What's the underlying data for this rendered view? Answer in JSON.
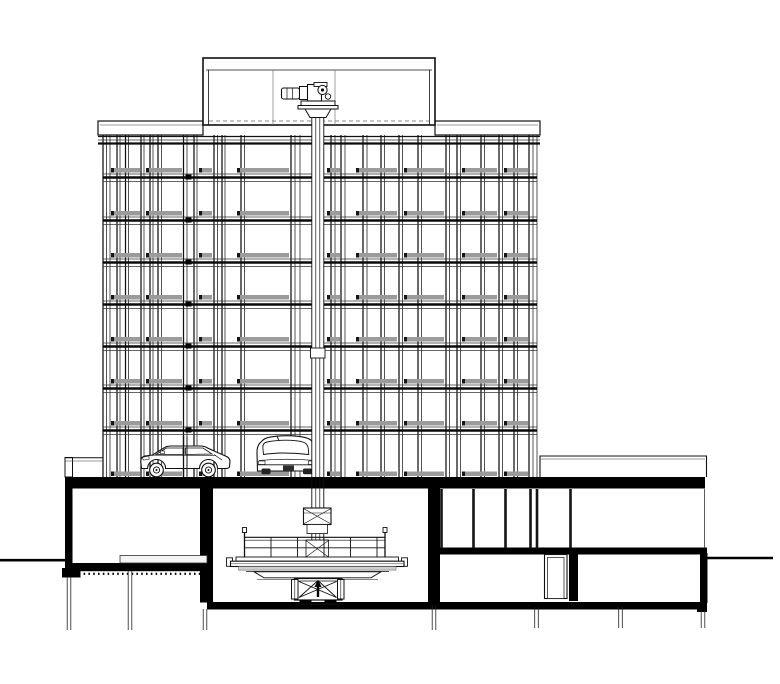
{
  "meta": {
    "drawing_type": "architectural-building-cross-section",
    "subject": "automated-parking-tower-with-roof-hoist-and-basement-turntable",
    "parking_levels": 8,
    "cars_visible": 2,
    "text_labels": []
  },
  "colors": {
    "background": "#ffffff",
    "line": "#111111",
    "thin": "#333333",
    "beam": "#0a0a0a",
    "poche": "#000000",
    "pallet": "#9b9b9b",
    "pallet_tick": "#161616",
    "mullion": "#141414",
    "deck_gray": "#cfcfcf",
    "light_gray": "#f4f4f4",
    "dash_gray": "#666666",
    "pile": "#222222"
  },
  "geometry": {
    "canvas": {
      "w": 780,
      "h": 684
    },
    "tower": {
      "col_y1": 135,
      "col_y2": 477,
      "column_clusters": [
        [
          103,
          106.5,
          110
        ],
        [
          117,
          120
        ],
        [
          125.5,
          128.5
        ],
        [
          141,
          144
        ],
        [
          150,
          153
        ],
        [
          158,
          161.5
        ],
        [
          183.5,
          187
        ],
        [
          194,
          197
        ],
        [
          214,
          217.5
        ],
        [
          222,
          225
        ],
        [
          241,
          244.5
        ],
        [
          291,
          295,
          300
        ],
        [
          331,
          335
        ],
        [
          341,
          345
        ],
        [
          363,
          367
        ],
        [
          381,
          384.5
        ],
        [
          399,
          402.5
        ],
        [
          418,
          421.5
        ],
        [
          446,
          449.5
        ],
        [
          457,
          460.5
        ],
        [
          481,
          484.5
        ],
        [
          499,
          502.5
        ],
        [
          514,
          517.5
        ],
        [
          529,
          533,
          537
        ]
      ],
      "top_band": {
        "y": 136,
        "x1": 98,
        "x2": 540
      },
      "floor_bands": [
        174,
        217,
        259,
        301,
        343,
        385,
        427
      ],
      "band_x1": 103,
      "band_x2": 537,
      "splice_x": [
        185.5
      ],
      "pallet_rows": [
        168,
        211,
        253,
        295,
        337,
        379,
        421,
        471.5
      ],
      "pallet_h": 4.5,
      "pallet_segments": [
        [
          111,
          140
        ],
        [
          146,
          182
        ],
        [
          199,
          212
        ],
        [
          237,
          289
        ],
        [
          327,
          340
        ],
        [
          356,
          397
        ],
        [
          404,
          444
        ],
        [
          462,
          497
        ],
        [
          504,
          528
        ]
      ],
      "pallet_ticks": [
        111,
        146,
        199,
        237,
        327,
        356,
        404,
        462,
        504
      ]
    },
    "right_building": {
      "mullions": [
        441.5,
        473.5,
        505.5,
        530.5,
        537,
        570.5
      ],
      "mullion_y1": 489,
      "mullion_y2": 548
    },
    "piles": [
      {
        "x": 69,
        "y1": 577,
        "y2": 630
      },
      {
        "x": 130,
        "y1": 571,
        "y2": 630
      },
      {
        "x": 205,
        "y1": 609,
        "y2": 630
      },
      {
        "x": 434,
        "y1": 605,
        "y2": 630
      },
      {
        "x": 536.5,
        "y1": 607,
        "y2": 628
      },
      {
        "x": 620.5,
        "y1": 607,
        "y2": 628
      },
      {
        "x": 703,
        "y1": 610,
        "y2": 628
      }
    ]
  }
}
